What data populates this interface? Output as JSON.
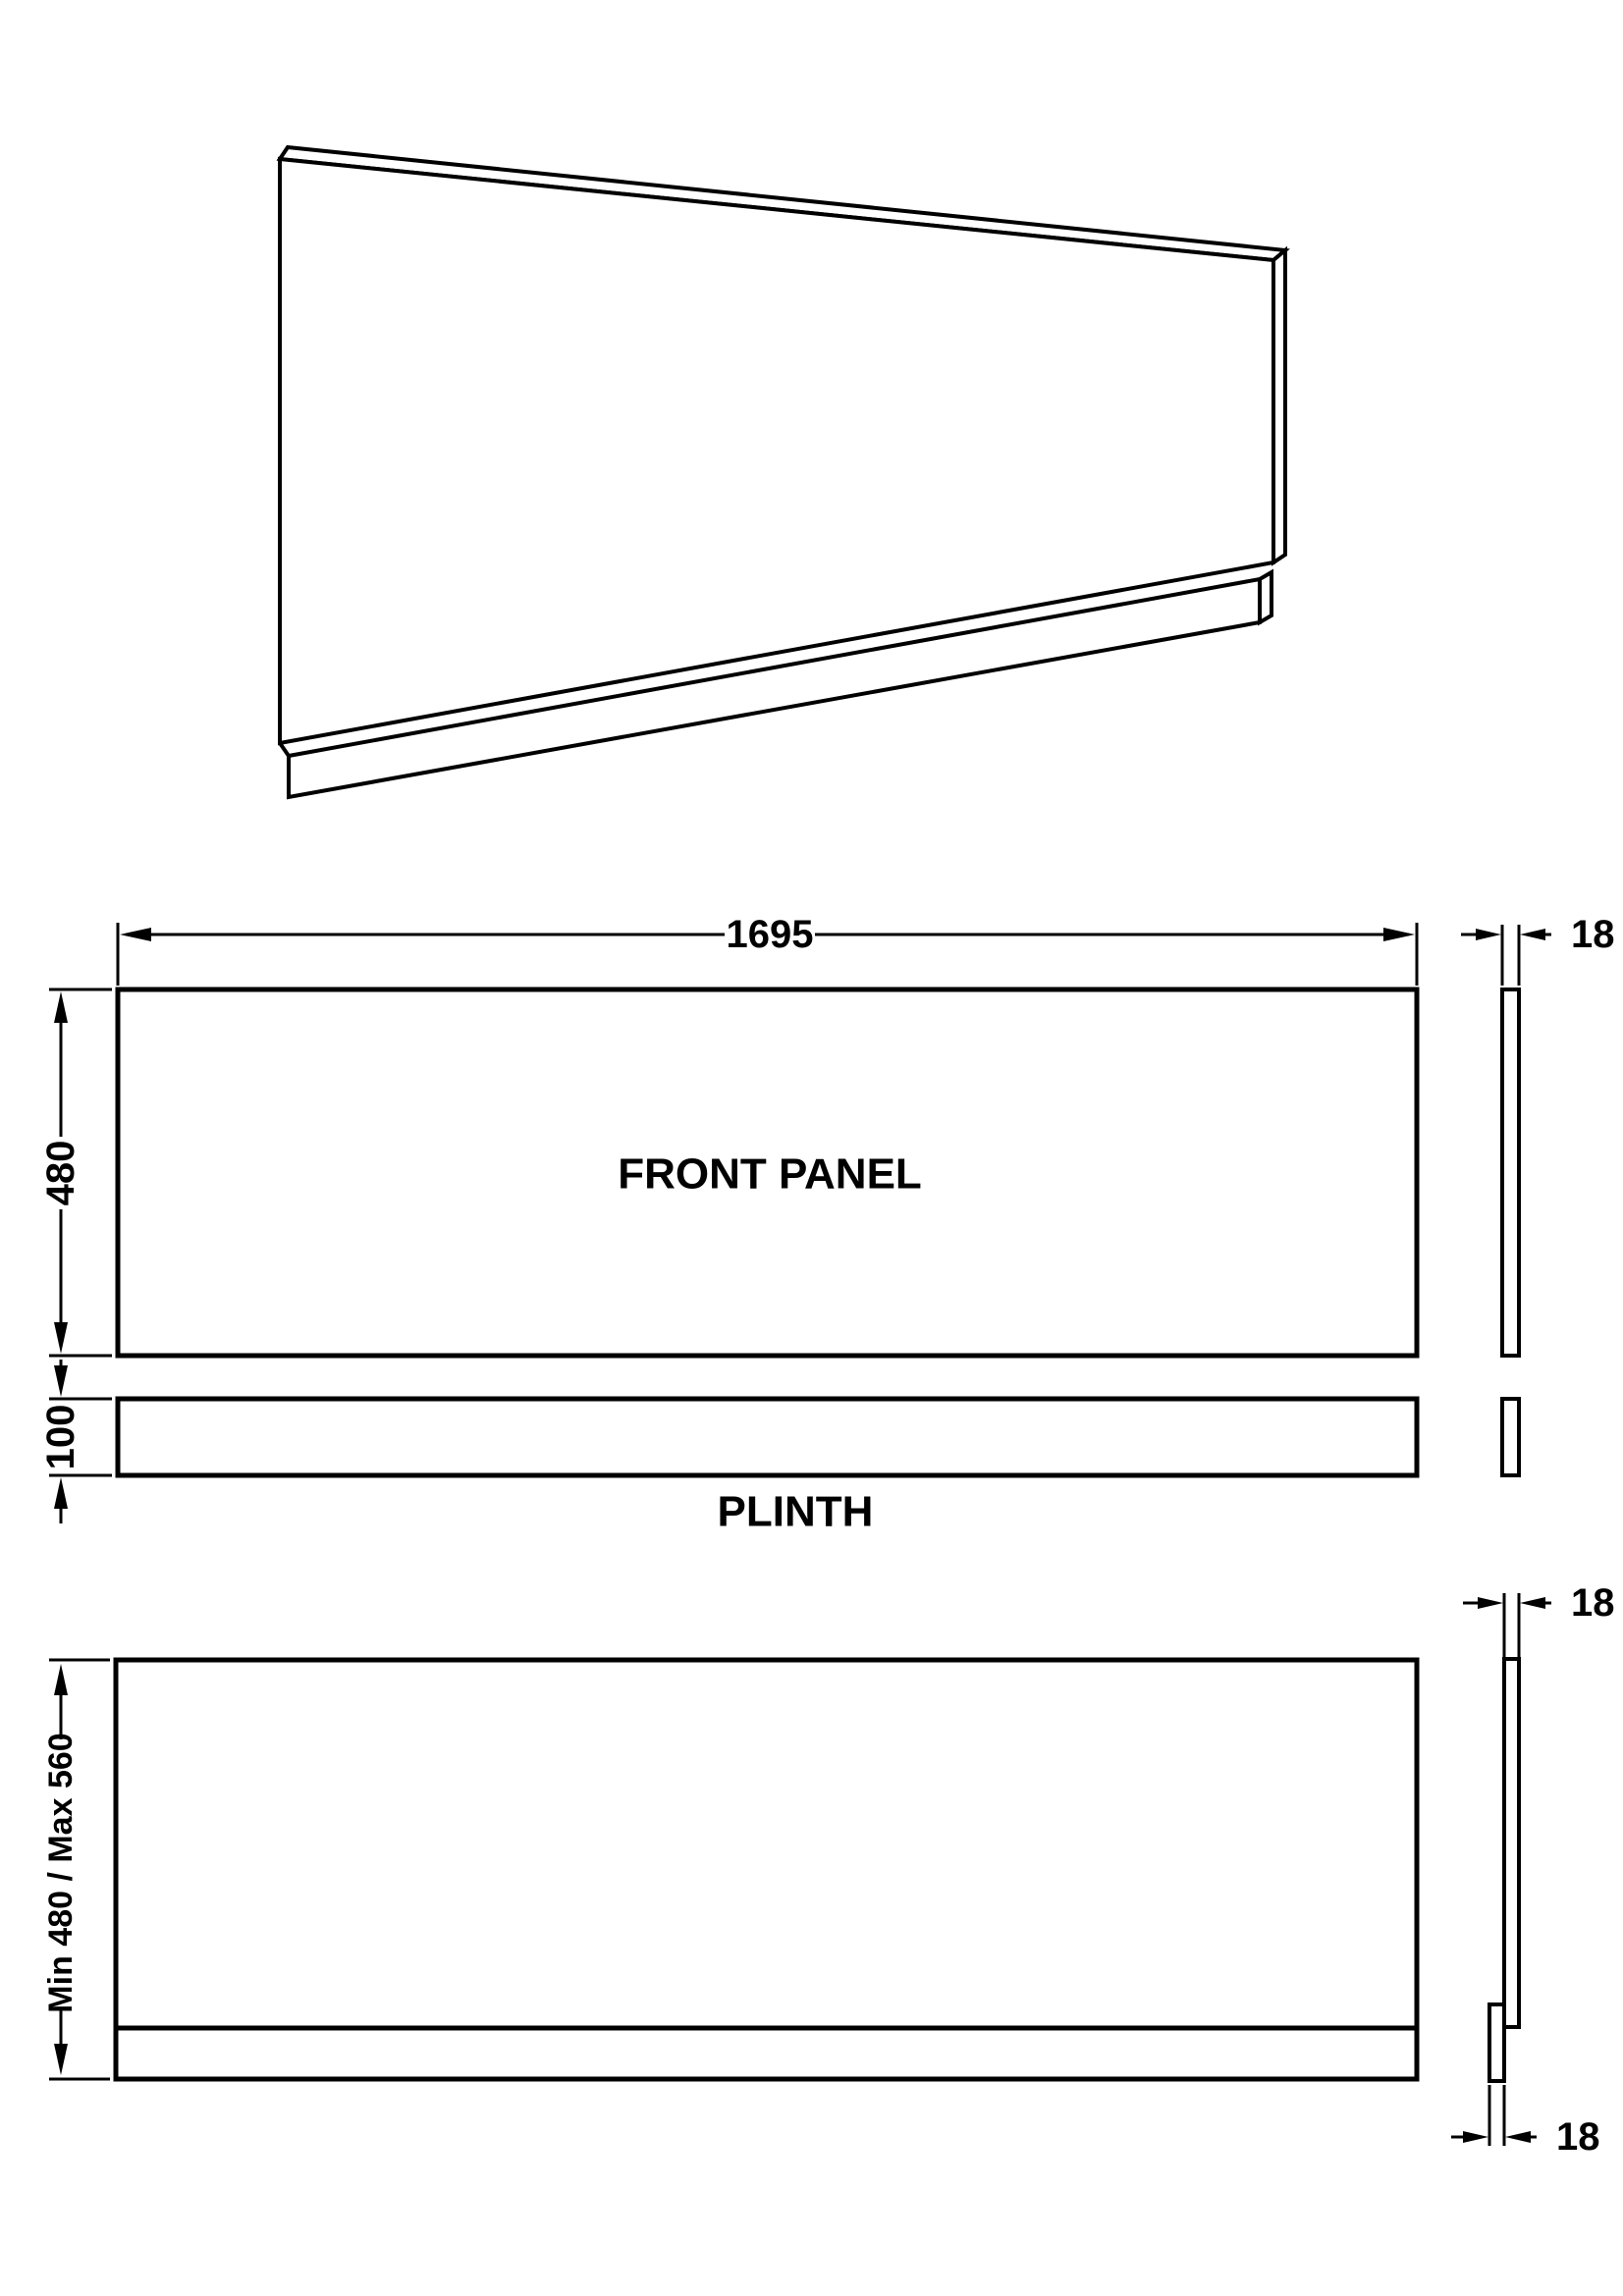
{
  "drawing": {
    "type": "technical-drawing",
    "background_color": "#ffffff",
    "line_color": "#000000",
    "labels": {
      "front_panel": "FRONT PANEL",
      "plinth": "PLINTH"
    },
    "dimensions": {
      "panel_width": "1695",
      "panel_height": "480",
      "plinth_height": "100",
      "panel_thickness_side": "18",
      "fitted_height_range": "Min 480 / Max 560",
      "fitted_panel_thickness_top": "18",
      "fitted_plinth_thickness_bottom": "18"
    }
  }
}
